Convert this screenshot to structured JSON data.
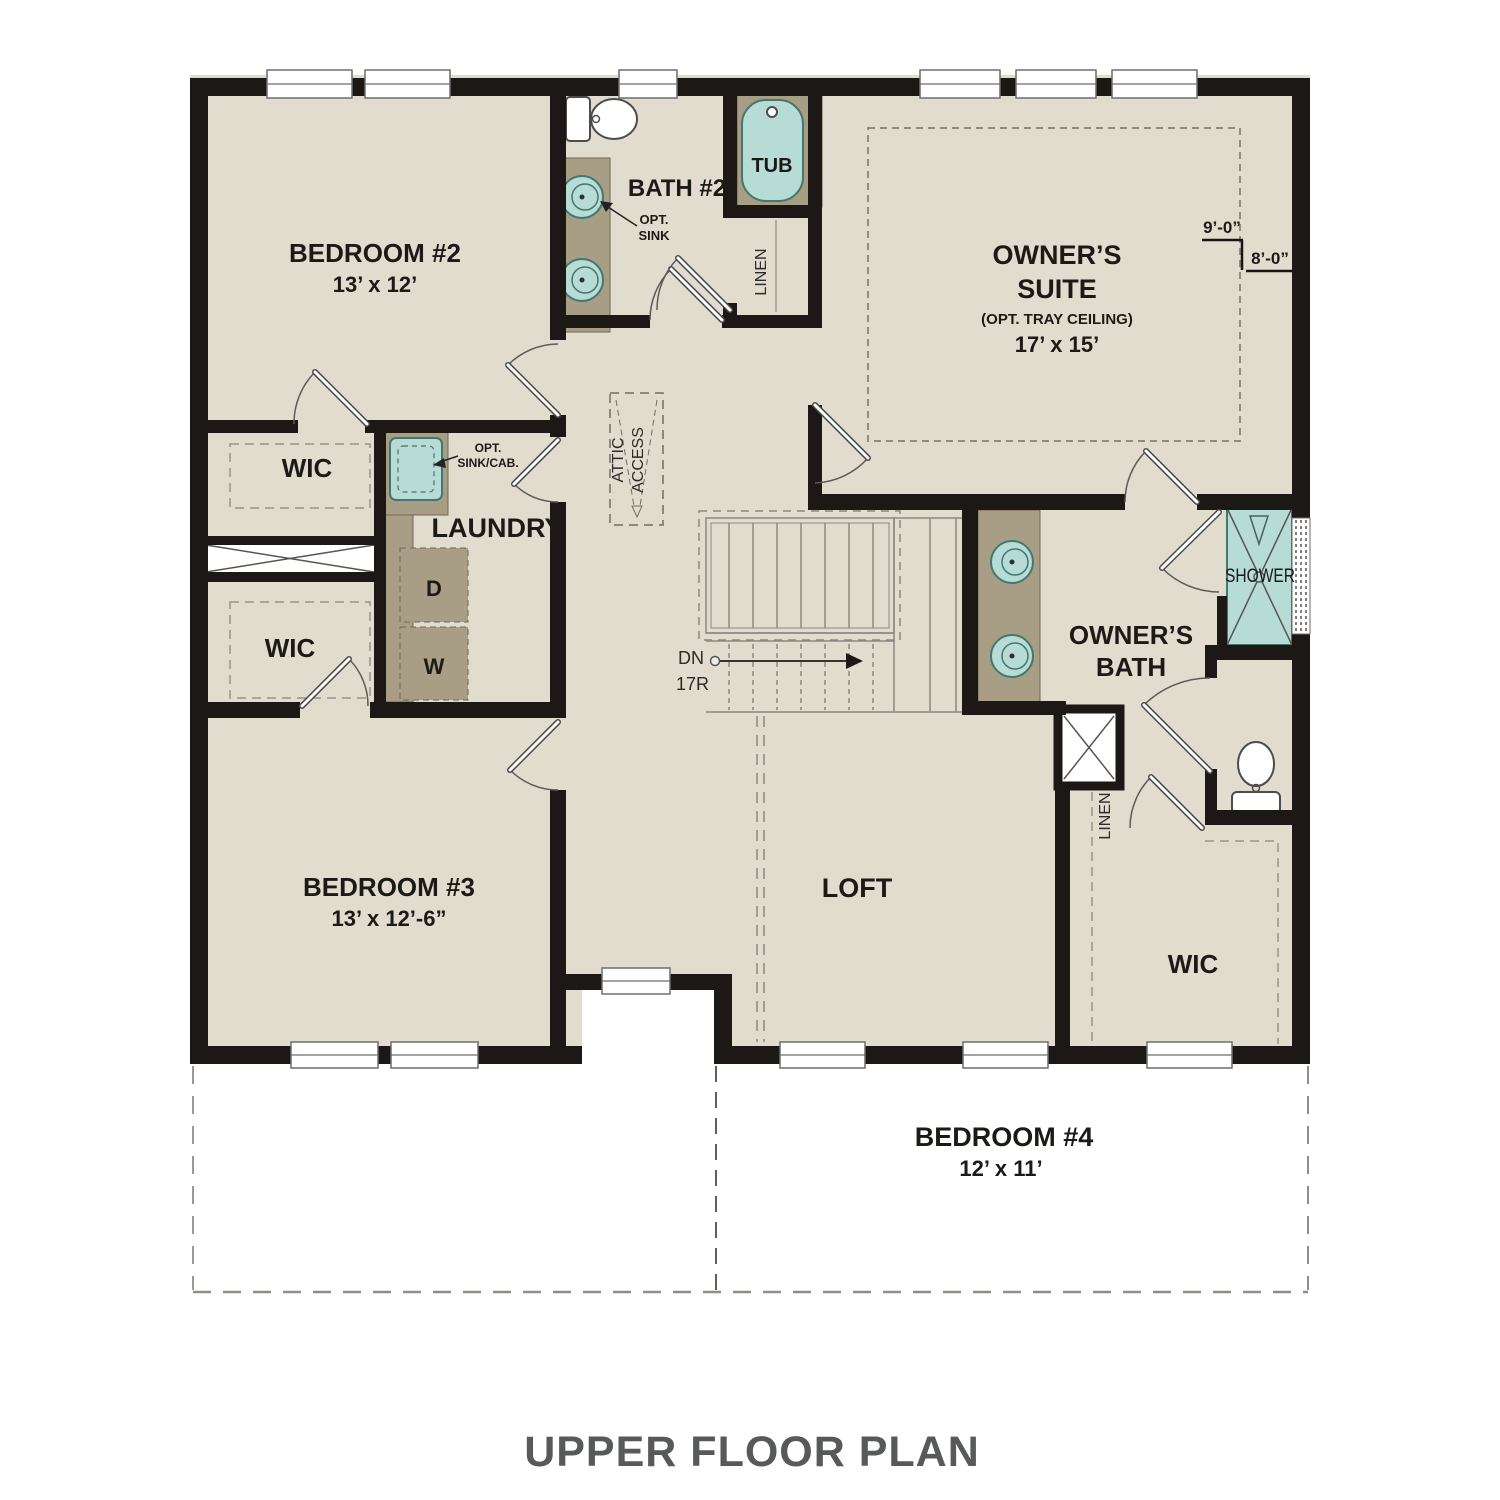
{
  "title": "UPPER FLOOR PLAN",
  "colors": {
    "floor": "#e1dccd",
    "wall": "#1b1815",
    "fixture_teal": "#b7dbd5",
    "counter_taupe": "#a89e86",
    "title_text": "#58595b"
  },
  "rooms": {
    "bedroom2": {
      "name": "BEDROOM #2",
      "dims": "13’ x 12’"
    },
    "bath2": {
      "name": "BATH #2"
    },
    "tub": {
      "label": "TUB"
    },
    "linen_upper": {
      "label": "LINEN"
    },
    "owners_suite": {
      "name_line1": "OWNER’S",
      "name_line2": "SUITE",
      "note": "(OPT. TRAY CEILING)",
      "dims": "17’ x 15’"
    },
    "wic_upper": {
      "label": "WIC"
    },
    "wic_lower": {
      "label": "WIC"
    },
    "laundry": {
      "name": "LAUNDRY",
      "dryer": "D",
      "washer": "W"
    },
    "attic": {
      "line1": "ATTIC",
      "line2": "ACCESS"
    },
    "stairs": {
      "dn": "DN",
      "risers": "17R"
    },
    "owners_bath": {
      "name_line1": "OWNER’S",
      "name_line2": "BATH"
    },
    "shower": {
      "label": "SHOWER"
    },
    "linen_lower": {
      "label": "LINEN"
    },
    "wic_suite": {
      "label": "WIC"
    },
    "bedroom3": {
      "name": "BEDROOM #3",
      "dims": "13’ x 12’-6”"
    },
    "loft": {
      "name": "LOFT"
    },
    "bedroom4": {
      "name": "BEDROOM #4",
      "dims": "12’ x 11’"
    }
  },
  "annotations": {
    "opt_sink": {
      "line1": "OPT.",
      "line2": "SINK"
    },
    "opt_sink_cab": {
      "line1": "OPT.",
      "line2": "SINK/CAB."
    },
    "ceiling_9": "9’-0”",
    "ceiling_8": "8’-0”"
  }
}
